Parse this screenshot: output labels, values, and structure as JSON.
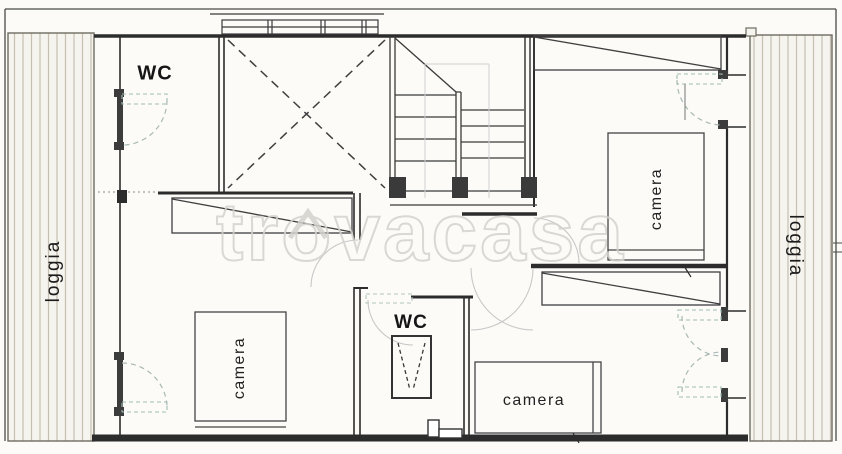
{
  "meta": {
    "type": "floor-plan",
    "width": 842,
    "height": 454
  },
  "watermark": {
    "text": "trovacasa"
  },
  "labels": {
    "wc_top": "WC",
    "wc_bottom": "WC",
    "camera_top_right": "camera",
    "camera_bottom_left": "camera",
    "camera_bottom_right": "camera",
    "loggia_left": "loggia",
    "loggia_right": "loggia"
  },
  "colors": {
    "line": "#3a3a3a",
    "wall": "#2c2c2c",
    "hatch_line": "#c6c0b2",
    "hatch_bg": "#f6f4ee",
    "door_arc": "#a9b8b3",
    "faint_arc": "#c8c8c8",
    "watermark": "#d4d2cd",
    "paper": "#fcfbf8"
  }
}
